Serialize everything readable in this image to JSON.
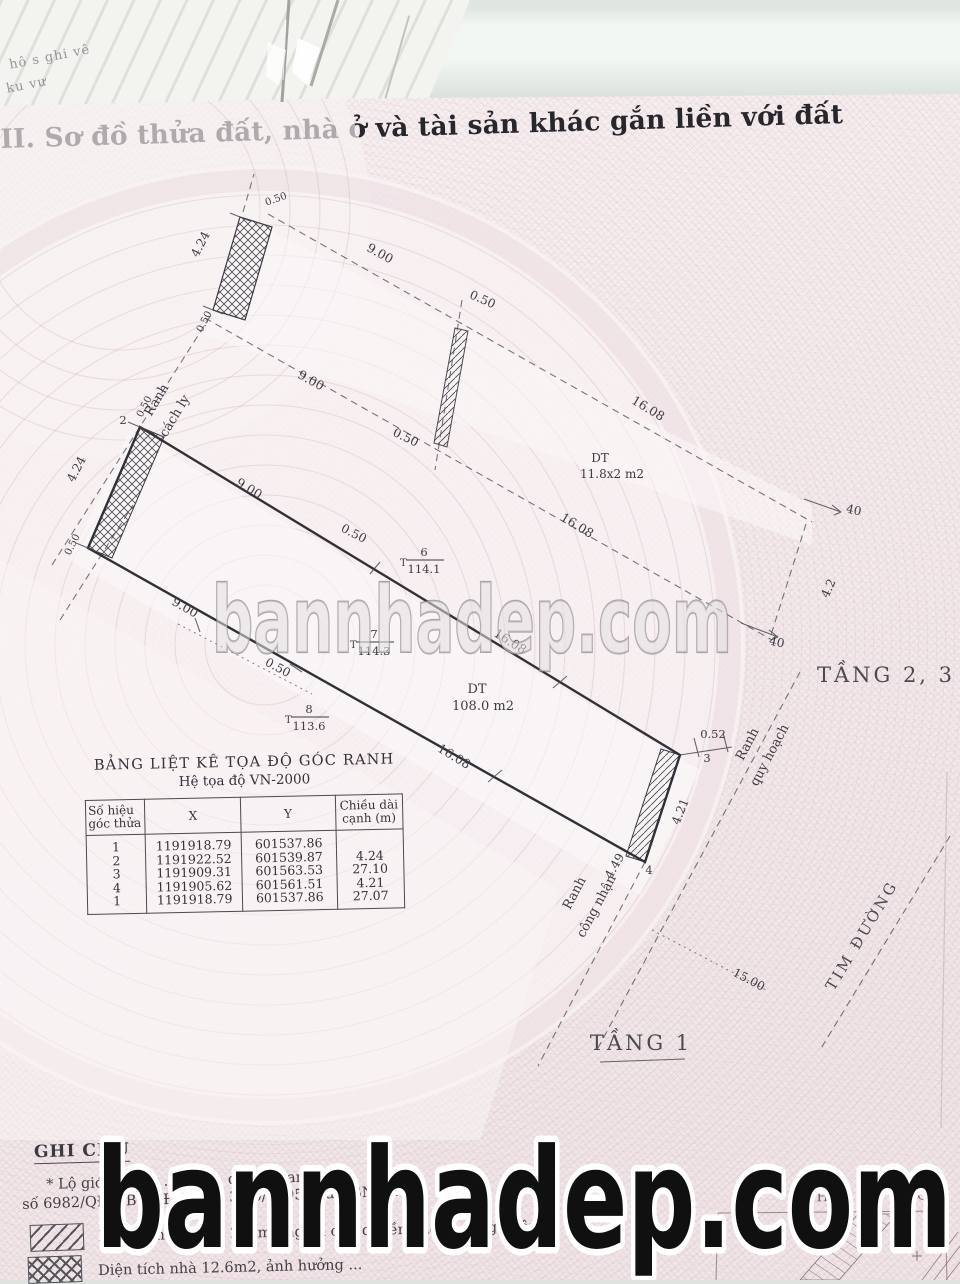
{
  "background": {
    "fragment1": "hô s ghi vê",
    "fragment2": "ku vư"
  },
  "title": "II. Sơ đồ thửa đất, nhà ở và tài sản khác gắn liền với đất",
  "watermark": {
    "center": "bannhadep.com",
    "bottom": "bannhadep.com"
  },
  "diagram": {
    "t_prefix": "T",
    "boundary_labels": {
      "ranh1": "Ranh",
      "cach_ly": "cách ly",
      "ranh2": "Ranh",
      "quy_hoach": "quy hoạch",
      "ranh3": "Ranh",
      "cong_nhan": "công nhận",
      "tim_duong": "TIM ĐƯỜNG"
    },
    "floor_labels": {
      "tang23": "TẦNG 2, 3",
      "tang1": "TẦNG 1"
    },
    "area_labels": {
      "dt1_label": "DT",
      "dt1_value": "108.0 m2",
      "dt2_label": "DT",
      "dt2_value": "11.8x2 m2"
    },
    "benchmarks": [
      {
        "no": "6",
        "val": "114.1"
      },
      {
        "no": "7",
        "val": "114.3"
      },
      {
        "no": "8",
        "val": "113.6"
      }
    ],
    "corner_numbers": {
      "p2": "2",
      "p3": "3",
      "p4": "4"
    },
    "dims": {
      "tb_len": "4.24",
      "tb_w1": "0.50",
      "tb_w2": "0.50",
      "c900a": "9.00",
      "c050a": "0.50",
      "c900b": "9.00",
      "c050b": "0.50",
      "c1608a": "16.08",
      "c1608b": "16.08",
      "p40a": "40",
      "p42": "4.2",
      "p40b": "40",
      "lw1": "0.50",
      "llen": "4.24",
      "lw2": "0.50",
      "e900": "9.00",
      "e050": "0.50",
      "e1608a": "16.08",
      "e1608b": "16.08",
      "b900": "9.00",
      "b050": "0.50",
      "d052": "0.52",
      "d421": "4.21",
      "d449": "4.49",
      "d1500": "15.00"
    }
  },
  "coordinate_table": {
    "title": "BẢNG LIỆT KÊ TỌA ĐỘ GÓC RANH",
    "subtitle": "Hệ tọa độ VN-2000",
    "headers": {
      "id": "Số hiệu\ngóc thửa",
      "x": "X",
      "y": "Y",
      "len": "Chiều dài\ncạnh (m)"
    },
    "rows": [
      {
        "id": "1",
        "x": "1191918.79",
        "y": "601537.86",
        "len": ""
      },
      {
        "id": "2",
        "x": "1191922.52",
        "y": "601539.87",
        "len": "4.24"
      },
      {
        "id": "3",
        "x": "1191909.31",
        "y": "601563.53",
        "len": "27.10"
      },
      {
        "id": "4",
        "x": "1191905.62",
        "y": "601561.51",
        "len": "4.21"
      },
      {
        "id": "1",
        "x": "1191918.79",
        "y": "601537.86",
        "len": "27.07"
      }
    ]
  },
  "notes": {
    "heading": "GHI CHÚ",
    "line1": "* Lộ giới đường ...0 m ... quy ... ban ... về",
    "line2": "số 6982/QĐ-UB-QLĐT ngày 30/9/1995 của UBND TP",
    "legend": [
      {
        "label": "Diện tích nhà đất 2.1 m2 ngoài chủ quyền không công nhận"
      },
      {
        "label": "Diện tích nhà 12.6m2, ảnh hưởng ..."
      }
    ],
    "right_fragment": "B      g H      P      Q"
  }
}
